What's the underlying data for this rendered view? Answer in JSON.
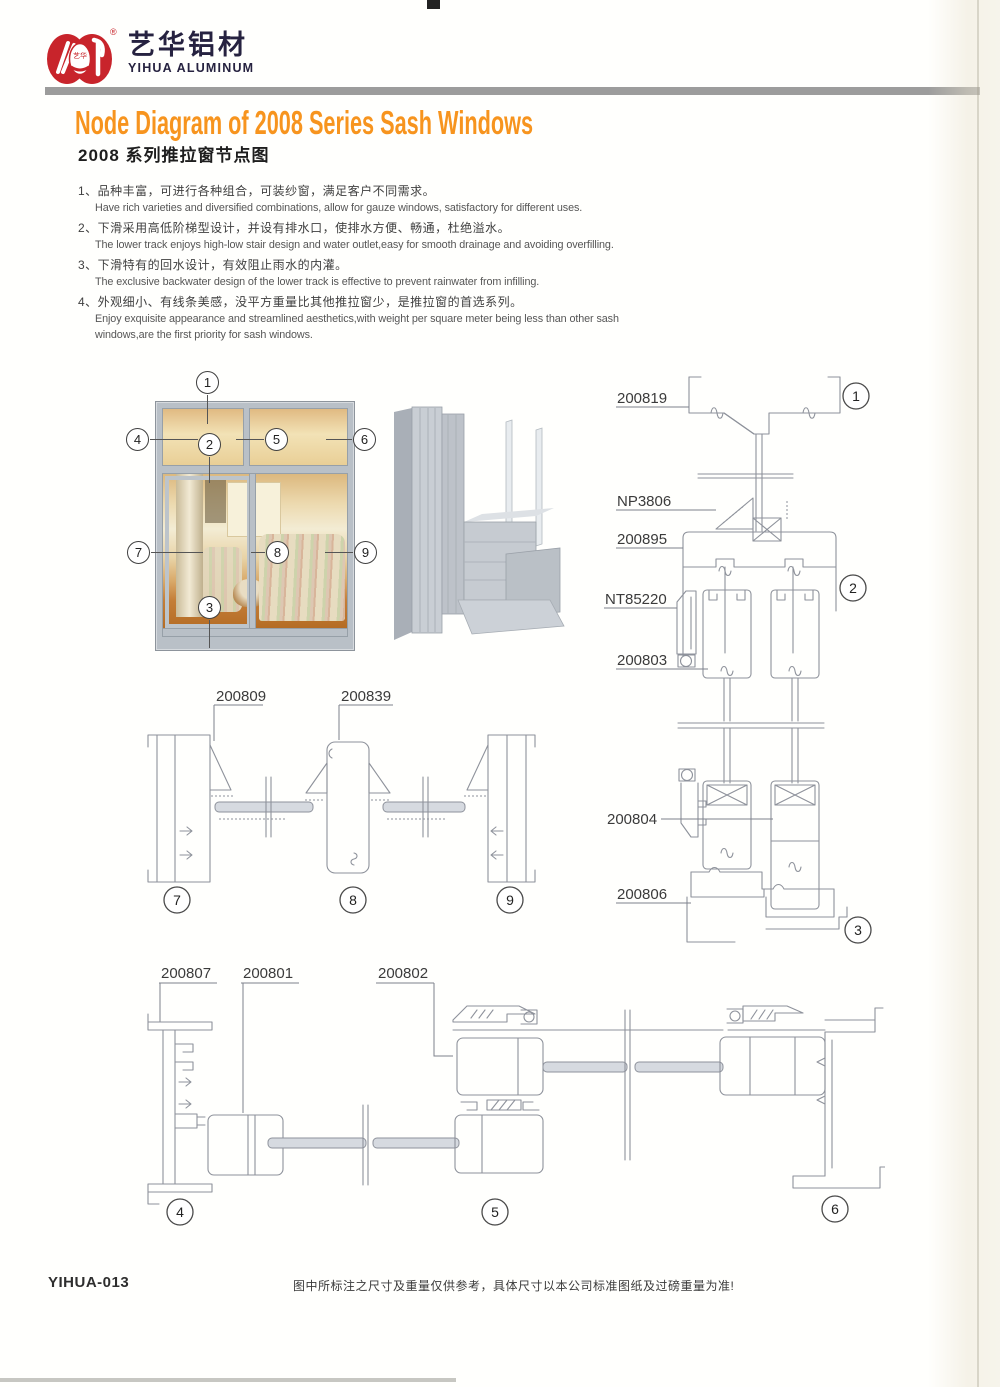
{
  "brand": {
    "name_zh": "艺华铝材",
    "name_en": "YIHUA ALUMINUM",
    "logo_seal_text": "艺华",
    "registered_mark": "®"
  },
  "colors": {
    "brand_red": "#c8242b",
    "accent_orange": "#f7941e",
    "brand_navy": "#262240",
    "diagram_line_gray": "#8e929b",
    "frame_silver": "#b9c0c7"
  },
  "title": {
    "en": "Node Diagram of 2008 Series Sash Windows",
    "zh": "2008 系列推拉窗节点图"
  },
  "features": [
    {
      "zh": "1、品种丰富，可进行各种组合，可装纱窗，满足客户不同需求。",
      "en": "Have rich varieties and diversified combinations, allow for gauze windows, satisfactory for different uses."
    },
    {
      "zh": "2、下滑采用高低阶梯型设计，并设有排水口，使排水方便、畅通，杜绝溢水。",
      "en": "The lower track enjoys high-low stair design and water outlet,easy for smooth drainage and avoiding overfilling."
    },
    {
      "zh": "3、下滑特有的回水设计，有效阻止雨水的内灌。",
      "en": "The exclusive backwater design of the lower track is effective to prevent rainwater from infilling."
    },
    {
      "zh": "4、外观细小、有线条美感，没平方重量比其他推拉窗少，是推拉窗的首选系列。",
      "en": "Enjoy exquisite appearance and streamlined aesthetics,with weight per square meter being less than other sash",
      "en2": "windows,are the first priority for sash windows."
    }
  ],
  "window_illustration": {
    "callouts": [
      "1",
      "2",
      "3",
      "4",
      "5",
      "6",
      "7",
      "8",
      "9"
    ]
  },
  "vertical_section": {
    "part_labels": [
      "200819",
      "NP3806",
      "200895",
      "NT85220",
      "200803",
      "200804",
      "200806"
    ],
    "node_markers": [
      "1",
      "2",
      "3"
    ]
  },
  "mid_horizontal_section": {
    "part_labels": [
      "200809",
      "200839"
    ],
    "node_markers": [
      "7",
      "8",
      "9"
    ]
  },
  "bottom_horizontal_section": {
    "part_labels": [
      "200807",
      "200801",
      "200802"
    ],
    "node_markers": [
      "4",
      "5",
      "6"
    ]
  },
  "footer": {
    "code": "YIHUA-013",
    "note": "图中所标注之尺寸及重量仅供参考，具体尺寸以本公司标准图纸及过磅重量为准!"
  }
}
